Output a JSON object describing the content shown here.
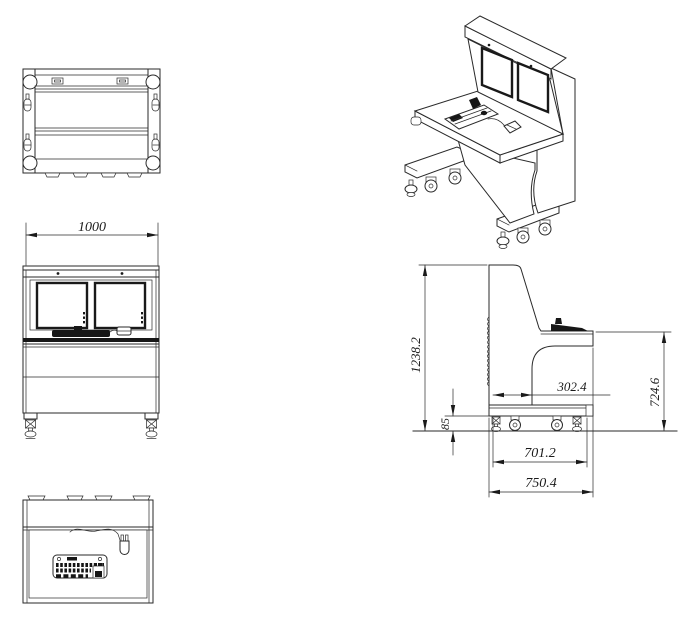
{
  "drawing": {
    "subject": "operator console technical drawing",
    "colors": {
      "line": "#2a2a2a",
      "background": "#ffffff"
    }
  },
  "dimensions": {
    "width": "1000",
    "overall_height": "1238.2",
    "ground_clearance": "85",
    "back_to_footwell": "302.4",
    "desk_height": "724.6",
    "base_depth": "701.2",
    "overall_depth": "750.4"
  }
}
